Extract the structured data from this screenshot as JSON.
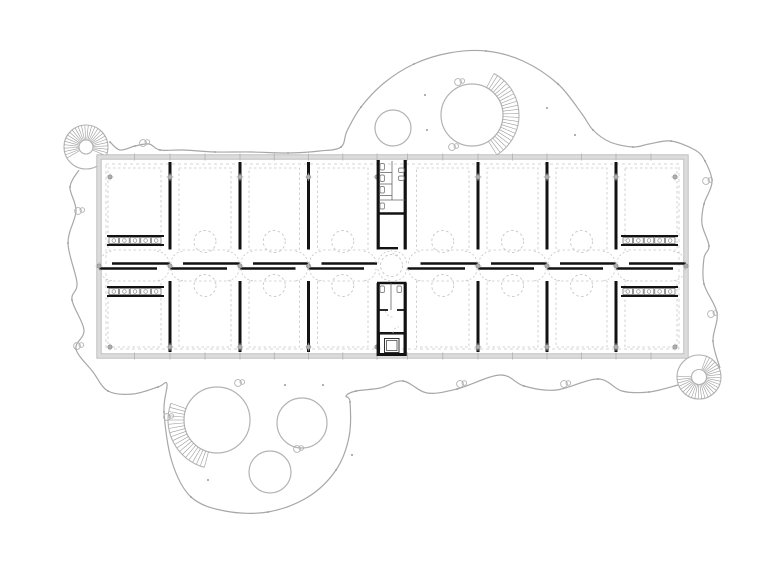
{
  "meta": {
    "drawing_kind": "architectural-floor-plan",
    "canvas": {
      "w": 780,
      "h": 572
    },
    "palette": {
      "background": "#ffffff",
      "site_line": "#a7a7a7",
      "tree_line": "#b3b3b3",
      "tread_line": "#9c9c9c",
      "wall_band": "#dcdcdc",
      "wall_edge": "#b5b5b5",
      "dash_line": "#c6c6c6",
      "black_wall": "#121212",
      "fixture": "#8a8a8a",
      "column_dot": "#9b9b9b",
      "site_dot": "#999999"
    }
  },
  "site": {
    "outline_paths": [
      [
        [
          79,
          170
        ],
        [
          70,
          187
        ],
        [
          76,
          211
        ],
        [
          68,
          243
        ],
        [
          77,
          283
        ],
        [
          72,
          300
        ],
        [
          84,
          330
        ],
        [
          76,
          349
        ],
        [
          93,
          372
        ],
        [
          108,
          391
        ],
        [
          133,
          394
        ],
        [
          158,
          387
        ],
        [
          167,
          384
        ],
        [
          164,
          412
        ],
        [
          172,
          462
        ],
        [
          191,
          497
        ],
        [
          225,
          511
        ],
        [
          268,
          512
        ],
        [
          308,
          497
        ],
        [
          336,
          470
        ],
        [
          349,
          437
        ],
        [
          350,
          402
        ],
        [
          346,
          396
        ],
        [
          356,
          391
        ],
        [
          380,
          388
        ],
        [
          403,
          381
        ],
        [
          427,
          393
        ],
        [
          457,
          389
        ],
        [
          500,
          375
        ],
        [
          524,
          386
        ],
        [
          556,
          390
        ],
        [
          598,
          379
        ],
        [
          622,
          391
        ],
        [
          649,
          392
        ],
        [
          678,
          385
        ]
      ],
      [
        [
          720,
          368
        ],
        [
          713,
          341
        ],
        [
          717,
          313
        ],
        [
          704,
          284
        ],
        [
          704,
          258
        ],
        [
          709,
          246
        ],
        [
          702,
          224
        ],
        [
          704,
          204
        ],
        [
          712,
          182
        ],
        [
          705,
          161
        ],
        [
          695,
          150
        ],
        [
          671,
          141
        ],
        [
          649,
          144
        ],
        [
          633,
          147
        ],
        [
          610,
          142
        ],
        [
          593,
          130
        ],
        [
          582,
          114
        ],
        [
          558,
          84
        ],
        [
          523,
          61
        ],
        [
          486,
          51
        ],
        [
          449,
          53
        ],
        [
          414,
          64
        ],
        [
          384,
          83
        ],
        [
          361,
          107
        ],
        [
          347,
          131
        ],
        [
          341,
          147
        ],
        [
          320,
          151
        ],
        [
          288,
          153
        ],
        [
          252,
          152
        ],
        [
          215,
          152
        ],
        [
          183,
          150
        ],
        [
          160,
          150
        ],
        [
          149,
          144
        ],
        [
          135,
          146
        ],
        [
          120,
          150
        ],
        [
          110,
          142
        ]
      ]
    ],
    "trees": [
      {
        "cx": 472,
        "cy": 115,
        "r": 31,
        "stair": {
          "r2": 47,
          "a0": -62,
          "a1": 62,
          "step": 5
        }
      },
      {
        "cx": 393,
        "cy": 128,
        "r": 18
      },
      {
        "cx": 217,
        "cy": 420,
        "r": 33,
        "stair": {
          "r2": 49,
          "a0": 105,
          "a1": 200,
          "step": 5
        }
      },
      {
        "cx": 302,
        "cy": 423,
        "r": 25
      },
      {
        "cx": 270,
        "cy": 472,
        "r": 21
      }
    ],
    "spiral_stairs": [
      {
        "cx": 86,
        "cy": 147,
        "ro": 22,
        "ri": 7,
        "a0": 150,
        "a1": 385,
        "step": 9
      },
      {
        "cx": 699,
        "cy": 377,
        "ro": 22,
        "ri": 7.5,
        "a0": -70,
        "a1": 190,
        "step": 9
      }
    ],
    "bumps": [
      [
        458,
        82
      ],
      [
        452,
        147
      ],
      [
        238,
        383
      ],
      [
        167,
        417
      ],
      [
        78,
        211
      ],
      [
        77,
        346
      ],
      [
        460,
        384
      ],
      [
        564,
        384
      ],
      [
        706,
        181
      ],
      [
        711,
        314
      ],
      [
        143,
        143
      ],
      [
        297,
        449
      ]
    ],
    "dots": [
      [
        425,
        95
      ],
      [
        427,
        130
      ],
      [
        547,
        108
      ],
      [
        285,
        385
      ],
      [
        323,
        385
      ],
      [
        575,
        135
      ],
      [
        208,
        480
      ],
      [
        352,
        455
      ]
    ]
  },
  "building": {
    "shell": {
      "x0": 99,
      "y0": 157,
      "x1": 686,
      "y1": 356,
      "band": 4.4,
      "dash_inset": 7
    },
    "rows": {
      "top": {
        "dash_y0": 168,
        "dash_y1": 250,
        "table_cy": 241.5,
        "part_y0": 162,
        "part_y1": 249.5
      },
      "bottom": {
        "dash_y0": 281,
        "dash_y1": 347,
        "table_cy": 285.5,
        "part_y0": 281,
        "part_y1": 352
      }
    },
    "bays": [
      {
        "x0": 99,
        "x1": 170,
        "end": "left"
      },
      {
        "x0": 170,
        "x1": 240
      },
      {
        "x0": 240,
        "x1": 308.5
      },
      {
        "x0": 308.5,
        "x1": 377
      },
      {
        "x0": 407.5,
        "x1": 478
      },
      {
        "x0": 478,
        "x1": 547
      },
      {
        "x0": 547,
        "x1": 616
      },
      {
        "x0": 616,
        "x1": 686,
        "end": "right"
      }
    ],
    "partitions": [
      170,
      240,
      308.5,
      478,
      547,
      616
    ],
    "table_r": 11,
    "corridor": {
      "y_top": 263.5,
      "y_bot": 268.5,
      "door": 13,
      "arc_r": 12,
      "junctions": [
        99,
        170,
        240,
        308.5,
        377,
        407.5,
        478,
        547,
        616,
        686
      ]
    },
    "columns": {
      "r": 2.2,
      "top": {
        "y": 177,
        "xs": [
          110,
          170,
          240,
          308.5,
          377,
          478,
          547,
          616,
          675
        ]
      },
      "bottom": {
        "y": 347,
        "xs": [
          110,
          170,
          240,
          308.5,
          377,
          478,
          547,
          616,
          675
        ]
      },
      "mid": {
        "y": 266,
        "xs": [
          99,
          170,
          240,
          308.5,
          478,
          547,
          616,
          686
        ]
      }
    },
    "mullions": {
      "xs": [
        134.5,
        170,
        205,
        240,
        274.3,
        308.5,
        342.8,
        377,
        407.5,
        442.8,
        478,
        512.5,
        547,
        581.5,
        616,
        651
      ],
      "half": 3.5
    },
    "counters": [
      {
        "x0": 107,
        "x1": 164,
        "y0": 236,
        "y1": 245,
        "cells": 5
      },
      {
        "x0": 107,
        "x1": 164,
        "y0": 287,
        "y1": 296,
        "cells": 5
      },
      {
        "x0": 621,
        "x1": 678,
        "y0": 236,
        "y1": 245,
        "cells": 5
      },
      {
        "x0": 621,
        "x1": 678,
        "y0": 287,
        "y1": 296,
        "cells": 5
      }
    ],
    "core": {
      "x0": 377,
      "x1": 406.5,
      "vwalls": [
        {
          "x": 378.2,
          "y0": 160,
          "y1": 249.5
        },
        {
          "x": 405.2,
          "y0": 160,
          "y1": 249.5
        },
        {
          "x": 378.2,
          "y0": 283,
          "y1": 356
        },
        {
          "x": 405.2,
          "y0": 283,
          "y1": 356
        }
      ],
      "hwalls": [
        {
          "y": 213.5,
          "x0": 377,
          "x1": 406.5,
          "w": 2.4
        },
        {
          "y": 248.2,
          "x0": 377,
          "x1": 398,
          "w": 2.4
        },
        {
          "y": 283,
          "x0": 377,
          "x1": 406.5,
          "w": 2.4
        },
        {
          "y": 310,
          "x0": 377,
          "x1": 388,
          "w": 1.8
        },
        {
          "y": 310,
          "x0": 397,
          "x1": 406.5,
          "w": 1.8
        },
        {
          "y": 333,
          "x0": 377,
          "x1": 406.5,
          "w": 2
        }
      ],
      "thin_h": [
        {
          "y": 200,
          "x0": 379,
          "x1": 405
        },
        {
          "y": 172.5,
          "x0": 379,
          "x1": 392
        },
        {
          "y": 184,
          "x0": 379,
          "x1": 392
        },
        {
          "y": 195.5,
          "x0": 379,
          "x1": 392
        }
      ],
      "thin_v": [
        {
          "x": 392,
          "y0": 161,
          "y1": 200
        },
        {
          "x": 391,
          "y0": 283,
          "y1": 310
        }
      ],
      "fixtures": [
        {
          "x": 380,
          "y": 163.5,
          "w": 4.5,
          "h": 6.5
        },
        {
          "x": 380,
          "y": 175,
          "w": 4.5,
          "h": 6.5
        },
        {
          "x": 380,
          "y": 186.5,
          "w": 4.5,
          "h": 6.5
        },
        {
          "x": 380,
          "y": 203,
          "w": 4.5,
          "h": 6
        },
        {
          "x": 398.5,
          "y": 168,
          "w": 5.5,
          "h": 4.5
        },
        {
          "x": 398.5,
          "y": 176,
          "w": 5.5,
          "h": 4.5
        },
        {
          "x": 380,
          "y": 286,
          "w": 4.5,
          "h": 6.5
        },
        {
          "x": 397,
          "y": 286,
          "w": 4.5,
          "h": 6.5
        }
      ],
      "door_arcs": [
        {
          "cx": 398,
          "cy": 248.2,
          "r": 7,
          "a0": 90,
          "a1": 180
        },
        {
          "cx": 392.5,
          "cy": 310,
          "r": 7,
          "a0": 90,
          "a1": 180
        },
        {
          "cx": 399,
          "cy": 333,
          "r": 6,
          "a0": 180,
          "a1": 270
        }
      ],
      "circle": {
        "cx": 391.5,
        "cy": 265.5,
        "r": 11
      },
      "elevator": {
        "x0": 377,
        "x1": 406.5,
        "y0": 333,
        "y1": 356,
        "wall": 3,
        "car": {
          "x": 384.5,
          "y": 338.5,
          "w": 14.5,
          "h": 14
        }
      }
    }
  }
}
